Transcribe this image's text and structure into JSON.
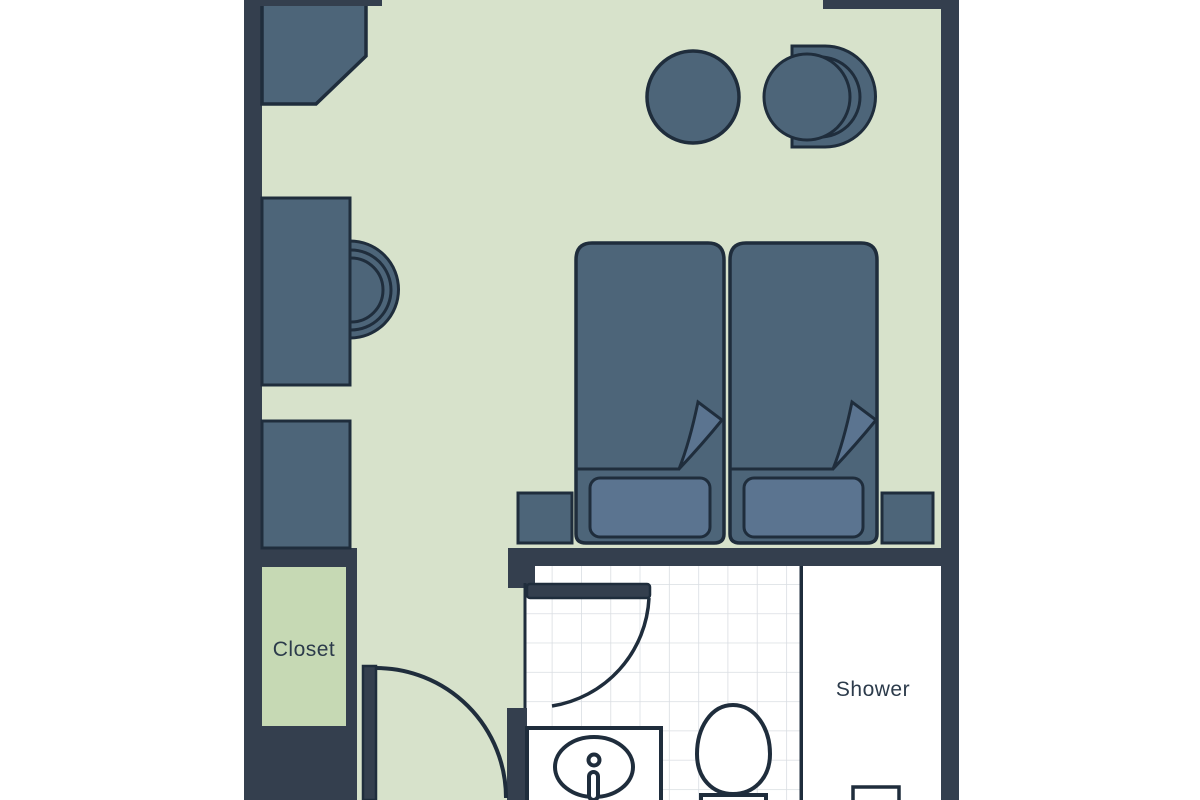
{
  "plan": {
    "type": "hotel-room-floor-plan",
    "labels": {
      "closet": "Closet",
      "shower": "Shower"
    },
    "rooms": [
      "bedroom",
      "closet",
      "bathroom",
      "shower"
    ],
    "furniture": [
      "corner-cabinet",
      "desk",
      "desk-chair",
      "dresser",
      "round-table",
      "lounge-chair",
      "twin-bed-left",
      "twin-bed-right",
      "pillow-left",
      "pillow-right",
      "nightstand-left",
      "nightstand-right",
      "entry-door",
      "bathroom-door",
      "sink-vanity",
      "toilet",
      "shower-fixture"
    ]
  },
  "colors": {
    "pageBg": "#ffffff",
    "wall": "#343f4e",
    "outline": "#1f2d3c",
    "furniture": "#4d6579",
    "soft": "#5b7490",
    "floor": "#d7e2cb",
    "closetFloor": "#c6d9b4",
    "bath": "#ffffff",
    "tile": "#d9dde2",
    "labelText": "#2c3b4b"
  }
}
